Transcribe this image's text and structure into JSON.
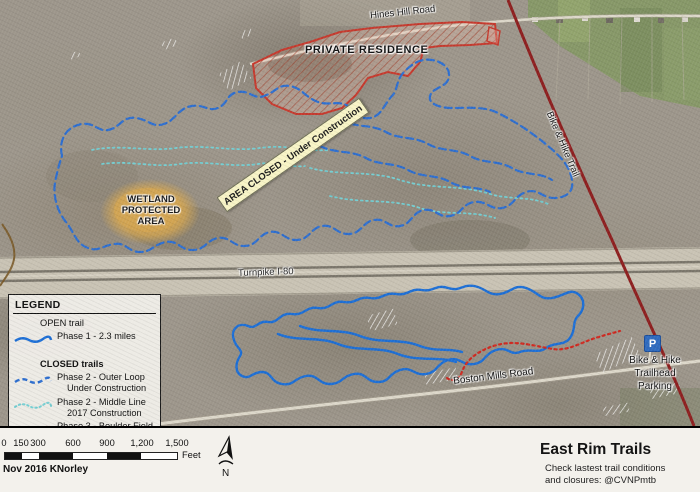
{
  "map": {
    "labels": {
      "hines_hill_road": "Hines Hill Road",
      "private_residence": "PRIVATE RESIDENCE",
      "area_closed": "AREA CLOSED - Under Construction",
      "wetland_line1": "WETLAND",
      "wetland_line2": "PROTECTED",
      "wetland_line3": "AREA",
      "turnpike": "Turnpike I-80",
      "bike_hike_trail": "Bike & Hike Trail",
      "boston_mills_road": "Boston Mills Road",
      "parking_icon": "P",
      "parking_line1": "Bike & Hike",
      "parking_line2": "Trailhead",
      "parking_line3": "Parking"
    },
    "colors": {
      "open_trail": "#1d6fd6",
      "closed_outer_loop": "#2e6fd0",
      "middle_line": "#74ced2",
      "boulder_field": "#cf2a21",
      "bike_hike_trail_line": "#8e1f1f",
      "area_closed_banner": "#f8f4c6",
      "private_residence_outline": "#c63a2e",
      "wetland_fill": "#d9a84e",
      "parking_blue": "#2f6bbf"
    }
  },
  "legend": {
    "title": "LEGEND",
    "open_header": "OPEN trail",
    "closed_header": "CLOSED trails",
    "items": [
      {
        "line1": "Phase 1 - 2.3 miles",
        "line2": ""
      },
      {
        "line1": "Phase 2 - Outer Loop",
        "line2": "Under Construction"
      },
      {
        "line1": "Phase 2 - Middle Line",
        "line2": "2017 Construction"
      },
      {
        "line1": "Phase 3 - Boulder Field",
        "line2": ""
      }
    ]
  },
  "footer": {
    "scale_ticks": [
      "0",
      "150",
      "300",
      "600",
      "900",
      "1,200",
      "1,500"
    ],
    "scale_unit": "Feet",
    "credit": "Nov 2016 KNorley",
    "north_label": "N",
    "title": "East Rim Trails",
    "subtitle_line1": "Check lastest trail conditions",
    "subtitle_line2": "and closures: @CVNPmtb"
  }
}
